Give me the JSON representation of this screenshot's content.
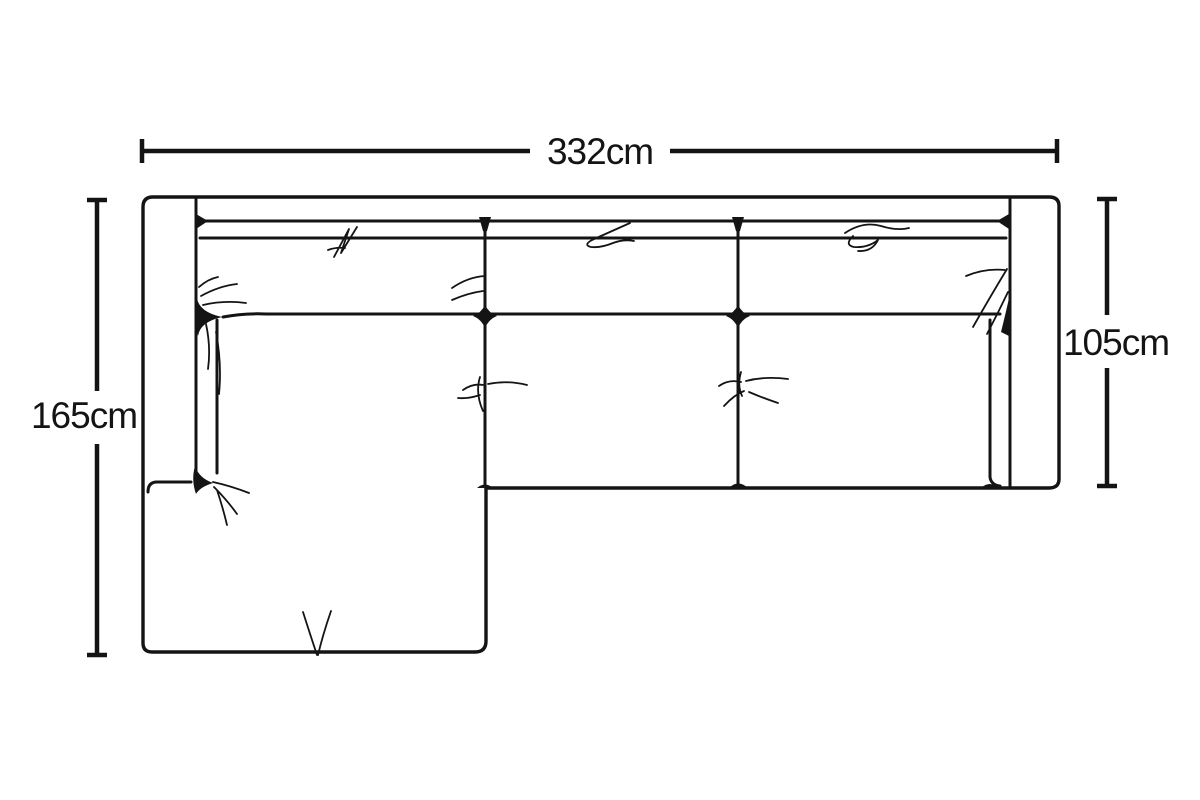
{
  "diagram": {
    "dimensions": {
      "overall_width": "332cm",
      "chaise_depth": "165cm",
      "sofa_depth": "105cm"
    },
    "colors": {
      "line": "#141414",
      "background": "#ffffff"
    }
  }
}
